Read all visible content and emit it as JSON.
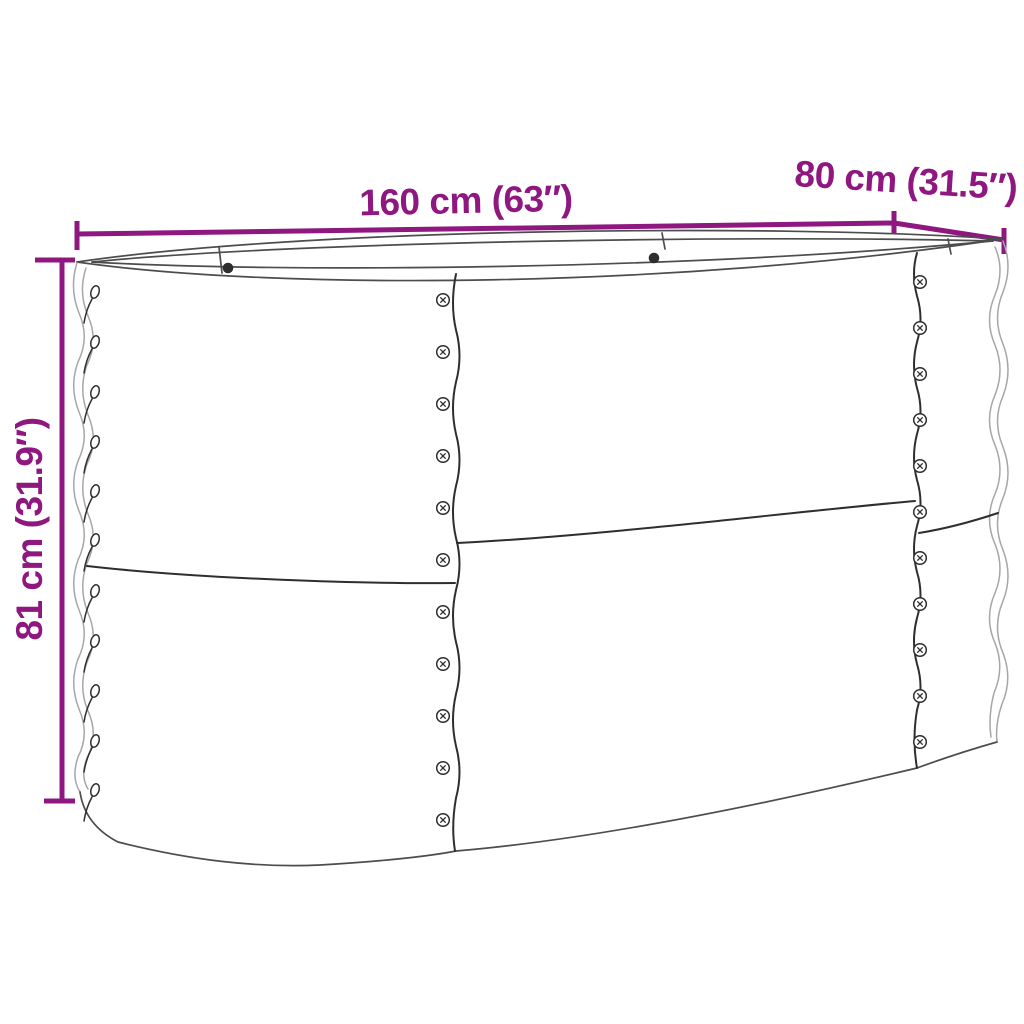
{
  "figure": {
    "kind": "product-dimension-diagram",
    "object": "oval-raised-garden-bed-planter",
    "features": [
      "open-oval-top-rim",
      "corrugated-side-edges",
      "vertical-panel-seams-with-screws",
      "edge-rivets",
      "horizontal-panel-seam"
    ]
  },
  "annotations": {
    "length_label": "160 cm (63″)",
    "width_label": "80 cm (31.5″)",
    "height_label": "81 cm (31.9″)"
  },
  "colors": {
    "accent": "#8E1780",
    "line_dark": "#2e2e2e",
    "line_medium": "#4d4d4d",
    "line_light": "#a6a6a6",
    "background": "#ffffff"
  },
  "icons": {
    "screw": "circled-cross-screw-head-icon",
    "rivet": "side-view-rivet-icon"
  }
}
